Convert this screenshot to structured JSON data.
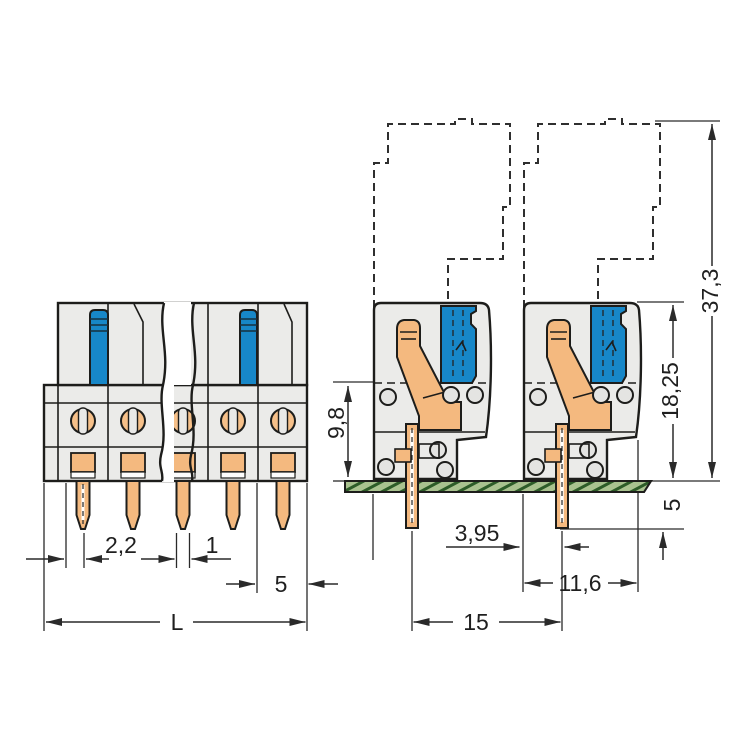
{
  "drawing_type": "connector-dimension-drawing",
  "labels": {
    "front": {
      "edge_to_pin": "2,2",
      "pin_width": "1",
      "pitch": "5",
      "total_length": "L"
    },
    "side": {
      "overall_height": "37,3",
      "height_above_pcb": "18,25",
      "clamp_height": "9,8",
      "pin_below_pcb": "5",
      "edge_to_pin": "3,95",
      "body_depth": "11,6",
      "min_spacing": "15"
    }
  },
  "colors": {
    "housing": "#ebebe9",
    "lever_blue": "#1787c8",
    "copper_orange": "#f4b97f",
    "pcb_green": "#a9c28f",
    "outline": "#1d1d1b"
  }
}
